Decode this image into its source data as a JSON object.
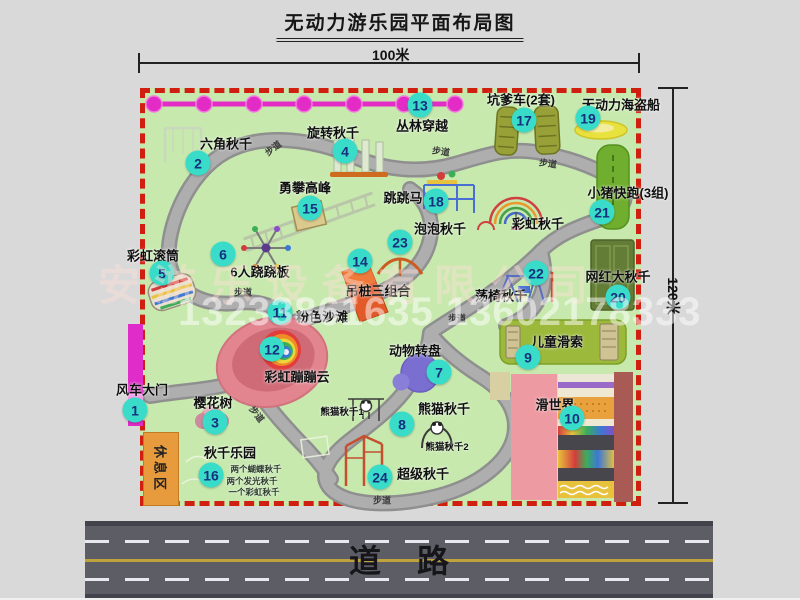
{
  "title": "无动力游乐园平面布局图",
  "dimensions": {
    "width_label": "100米",
    "height_label": "120米"
  },
  "road": {
    "label": "道路"
  },
  "watermark": {
    "company": "安游乐设备有限公司",
    "phone": "13233861635 13602178333"
  },
  "rest_area": {
    "label": "休息区"
  },
  "colors": {
    "map_green": "#c7e9ae",
    "path_gray": "#a8a8a8",
    "border_red": "#d01f10",
    "marker_teal": "#38dcc9",
    "marker_text": "#16307e",
    "chain_magenta": "#e32cc6",
    "gate_magenta": "#e02cc8",
    "rest_orange": "#e89b3c",
    "road_gray": "#5d5d66"
  },
  "map": {
    "items": [
      {
        "number": "1",
        "label": "风车大门",
        "marker": {
          "x": 135,
          "y": 410
        },
        "label_pos": {
          "x": 142,
          "y": 389
        }
      },
      {
        "number": "2",
        "label": "六角秋千",
        "marker": {
          "x": 198,
          "y": 163
        },
        "label_pos": {
          "x": 226,
          "y": 143
        }
      },
      {
        "number": "3",
        "label": "樱花树",
        "marker": {
          "x": 215,
          "y": 422
        },
        "label_pos": {
          "x": 213,
          "y": 402
        }
      },
      {
        "number": "4",
        "label": "旋转秋千",
        "marker": {
          "x": 345,
          "y": 151
        },
        "label_pos": {
          "x": 333,
          "y": 132
        }
      },
      {
        "number": "5",
        "label": "彩虹滚筒",
        "marker": {
          "x": 162,
          "y": 273
        },
        "label_pos": {
          "x": 153,
          "y": 255
        }
      },
      {
        "number": "6",
        "label": "6人跷跷板",
        "marker": {
          "x": 223,
          "y": 254
        },
        "label_pos": {
          "x": 260,
          "y": 271
        }
      },
      {
        "number": "7",
        "label": "动物转盘",
        "marker": {
          "x": 439,
          "y": 372
        },
        "label_pos": {
          "x": 415,
          "y": 350
        }
      },
      {
        "number": "8",
        "label": "熊猫秋千",
        "marker": {
          "x": 402,
          "y": 424
        },
        "label_pos": {
          "x": 444,
          "y": 408
        }
      },
      {
        "number": "9",
        "label": "儿童滑索",
        "marker": {
          "x": 528,
          "y": 357
        },
        "label_pos": {
          "x": 557,
          "y": 341
        }
      },
      {
        "number": "10",
        "label": "滑世界",
        "marker": {
          "x": 572,
          "y": 418
        },
        "label_pos": {
          "x": 555,
          "y": 404
        }
      },
      {
        "number": "11",
        "label": "粉色沙滩",
        "marker": {
          "x": 280,
          "y": 312
        },
        "label_pos": {
          "x": 322,
          "y": 316
        }
      },
      {
        "number": "12",
        "label": "彩虹蹦蹦云",
        "marker": {
          "x": 272,
          "y": 349
        },
        "label_pos": {
          "x": 297,
          "y": 376
        }
      },
      {
        "number": "13",
        "label": "丛林穿越",
        "marker": {
          "x": 420,
          "y": 105
        },
        "label_pos": {
          "x": 422,
          "y": 125
        }
      },
      {
        "number": "14",
        "label": "吊桩三组合",
        "marker": {
          "x": 360,
          "y": 261
        },
        "label_pos": {
          "x": 378,
          "y": 290
        }
      },
      {
        "number": "15",
        "label": "勇攀高峰",
        "marker": {
          "x": 310,
          "y": 208
        },
        "label_pos": {
          "x": 305,
          "y": 187
        }
      },
      {
        "number": "16",
        "label": "秋千乐园",
        "marker": {
          "x": 211,
          "y": 475
        },
        "label_pos": {
          "x": 230,
          "y": 452
        }
      },
      {
        "number": "17",
        "label": "坑爹车(2套)",
        "marker": {
          "x": 524,
          "y": 120
        },
        "label_pos": {
          "x": 521,
          "y": 99
        }
      },
      {
        "number": "18",
        "label": "跳跳马",
        "marker": {
          "x": 436,
          "y": 201
        },
        "label_pos": {
          "x": 403,
          "y": 197
        }
      },
      {
        "number": "19",
        "label": "无动力海盗船",
        "marker": {
          "x": 588,
          "y": 118
        },
        "label_pos": {
          "x": 621,
          "y": 104
        }
      },
      {
        "number": "20",
        "label": "网红大秋千",
        "marker": {
          "x": 618,
          "y": 297
        },
        "label_pos": {
          "x": 618,
          "y": 276
        }
      },
      {
        "number": "21",
        "label": "小猪快跑(3组)",
        "marker": {
          "x": 602,
          "y": 212
        },
        "label_pos": {
          "x": 628,
          "y": 192
        }
      },
      {
        "number": "22",
        "label": "荡椅秋千",
        "marker": {
          "x": 536,
          "y": 273
        },
        "label_pos": {
          "x": 501,
          "y": 295
        }
      },
      {
        "number": "23",
        "label": "泡泡秋千",
        "marker": {
          "x": 400,
          "y": 242
        },
        "label_pos": {
          "x": 440,
          "y": 228
        }
      },
      {
        "number": "24",
        "label": "超级秋千",
        "marker": {
          "x": 380,
          "y": 477
        },
        "label_pos": {
          "x": 423,
          "y": 473
        }
      }
    ],
    "sub_labels": [
      {
        "text": "彩虹秋千",
        "x": 538,
        "y": 223,
        "cls": ""
      },
      {
        "text": "熊猫秋千1",
        "x": 342,
        "y": 411,
        "cls": "s"
      },
      {
        "text": "熊猫秋千2",
        "x": 447,
        "y": 446,
        "cls": "s"
      },
      {
        "text": "两个蝴蝶秋千",
        "x": 256,
        "y": 469,
        "cls": "xs"
      },
      {
        "text": "两个发光秋千",
        "x": 252,
        "y": 481,
        "cls": "xs"
      },
      {
        "text": "一个彩虹秋千",
        "x": 254,
        "y": 492,
        "cls": "xs"
      }
    ],
    "path_labels": [
      {
        "text": "步道",
        "x": 273,
        "y": 148,
        "rot": -38
      },
      {
        "text": "步道",
        "x": 441,
        "y": 151,
        "rot": 8
      },
      {
        "text": "步道",
        "x": 548,
        "y": 163,
        "rot": 8
      },
      {
        "text": "步道",
        "x": 243,
        "y": 292,
        "rot": 0
      },
      {
        "text": "步道",
        "x": 457,
        "y": 318,
        "rot": 0
      },
      {
        "text": "步道",
        "x": 257,
        "y": 414,
        "rot": 52
      },
      {
        "text": "步道",
        "x": 382,
        "y": 500,
        "rot": 0
      }
    ]
  }
}
